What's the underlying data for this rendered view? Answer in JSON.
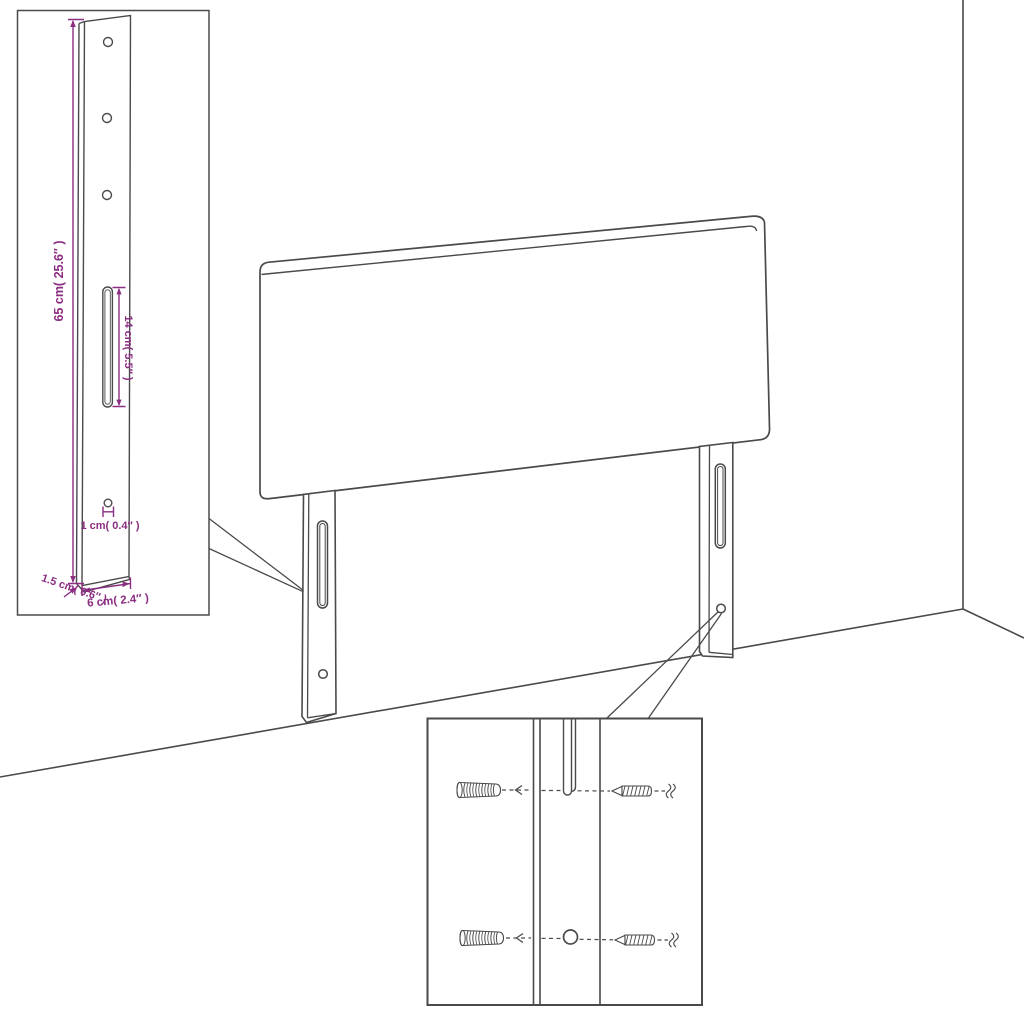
{
  "page": {
    "background": "#ffffff",
    "type": "assembly-instruction-diagram",
    "subject": "upholstered bed headboard with two wall-mount legs shown against a room corner, with a leg dimension inset and a wall-fixing hardware inset"
  },
  "colors": {
    "line": "#4a4a4a",
    "dimension": "#8b2d81",
    "background": "#ffffff"
  },
  "dimension_inset": {
    "labels": {
      "leg_height": "65 cm( 25.6″ )",
      "slot_length": "14 cm( 5.5″ )",
      "hole_diameter": "1 cm( 0.4″ )",
      "leg_width": "6 cm( 2.4″ )",
      "leg_thickness": "1.5 cm( 0.6″ )"
    },
    "features": [
      "three screw holes",
      "long mounting slot",
      "small lower hole"
    ]
  },
  "hardware_inset": {
    "items": [
      "wall plug",
      "screw"
    ],
    "rows": 2,
    "alignment": "dashed leader lines through slot and hole"
  }
}
